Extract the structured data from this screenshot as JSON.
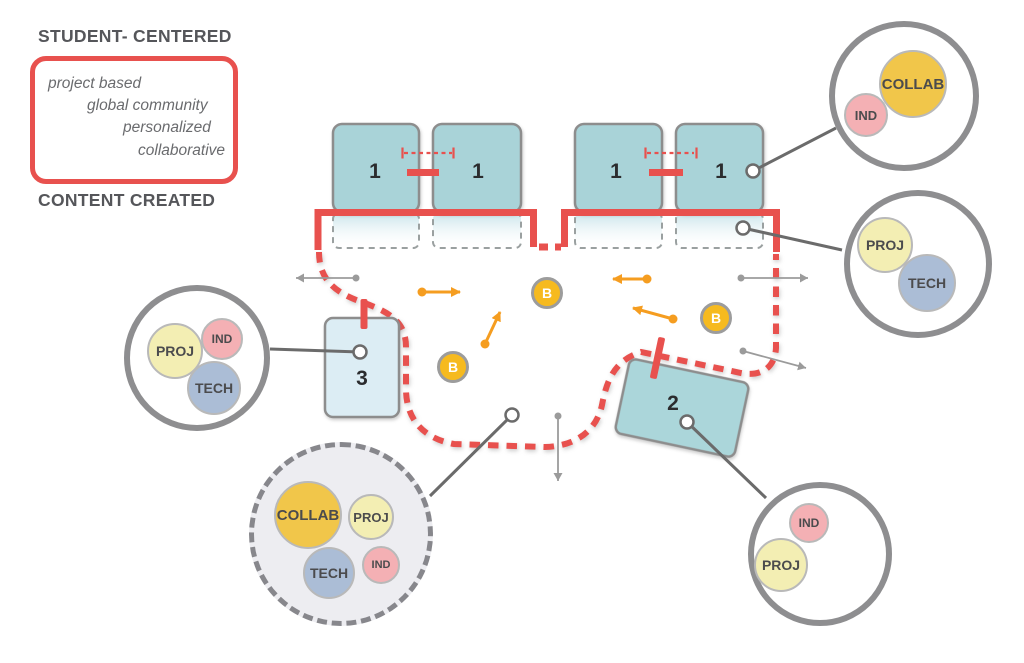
{
  "headings": {
    "student_centered": "STUDENT- CENTERED",
    "content_created": "CONTENT CREATED"
  },
  "legend": {
    "lines": [
      "project based",
      "global community",
      "personalized",
      "collaborative"
    ]
  },
  "rooms": {
    "classrooms": [
      {
        "label": "1"
      },
      {
        "label": "1"
      },
      {
        "label": "1"
      },
      {
        "label": "1"
      }
    ],
    "flex_room": {
      "label": "3"
    },
    "breakout_room": {
      "label": "2"
    }
  },
  "b_markers": [
    {
      "label": "B"
    },
    {
      "label": "B"
    },
    {
      "label": "B"
    }
  ],
  "annotations": [
    {
      "id": "collab-ind",
      "bubbles": [
        {
          "label": "COLLAB",
          "color": "#f1c64a"
        },
        {
          "label": "IND",
          "color": "#f4b0b4"
        }
      ]
    },
    {
      "id": "proj-tech",
      "bubbles": [
        {
          "label": "PROJ",
          "color": "#f3eeb3"
        },
        {
          "label": "TECH",
          "color": "#abbdd6"
        }
      ]
    },
    {
      "id": "proj-ind-tech",
      "bubbles": [
        {
          "label": "PROJ",
          "color": "#f3eeb3"
        },
        {
          "label": "IND",
          "color": "#f4b0b4"
        },
        {
          "label": "TECH",
          "color": "#abbdd6"
        }
      ]
    },
    {
      "id": "ind-proj",
      "bubbles": [
        {
          "label": "IND",
          "color": "#f4b0b4"
        },
        {
          "label": "PROJ",
          "color": "#f3eeb3"
        }
      ]
    },
    {
      "id": "commons-dashed",
      "bubbles": [
        {
          "label": "COLLAB",
          "color": "#f1c64a"
        },
        {
          "label": "PROJ",
          "color": "#f3eeb3"
        },
        {
          "label": "TECH",
          "color": "#abbdd6"
        },
        {
          "label": "IND",
          "color": "#f4b0b4"
        }
      ]
    }
  ],
  "palette": {
    "accent_red": "#e8514e",
    "classroom_teal": "#a9d3d8",
    "flex_room_blue": "#dcedf4",
    "marker_yellow": "#f6ba1f",
    "arrow_orange": "#f59d20",
    "circle_border_gray": "#8e8e90",
    "collab_yellow": "#f1c64a",
    "proj_pale_yellow": "#f3eeb3",
    "tech_blue": "#abbdd6",
    "ind_pink": "#f4b0b4"
  }
}
